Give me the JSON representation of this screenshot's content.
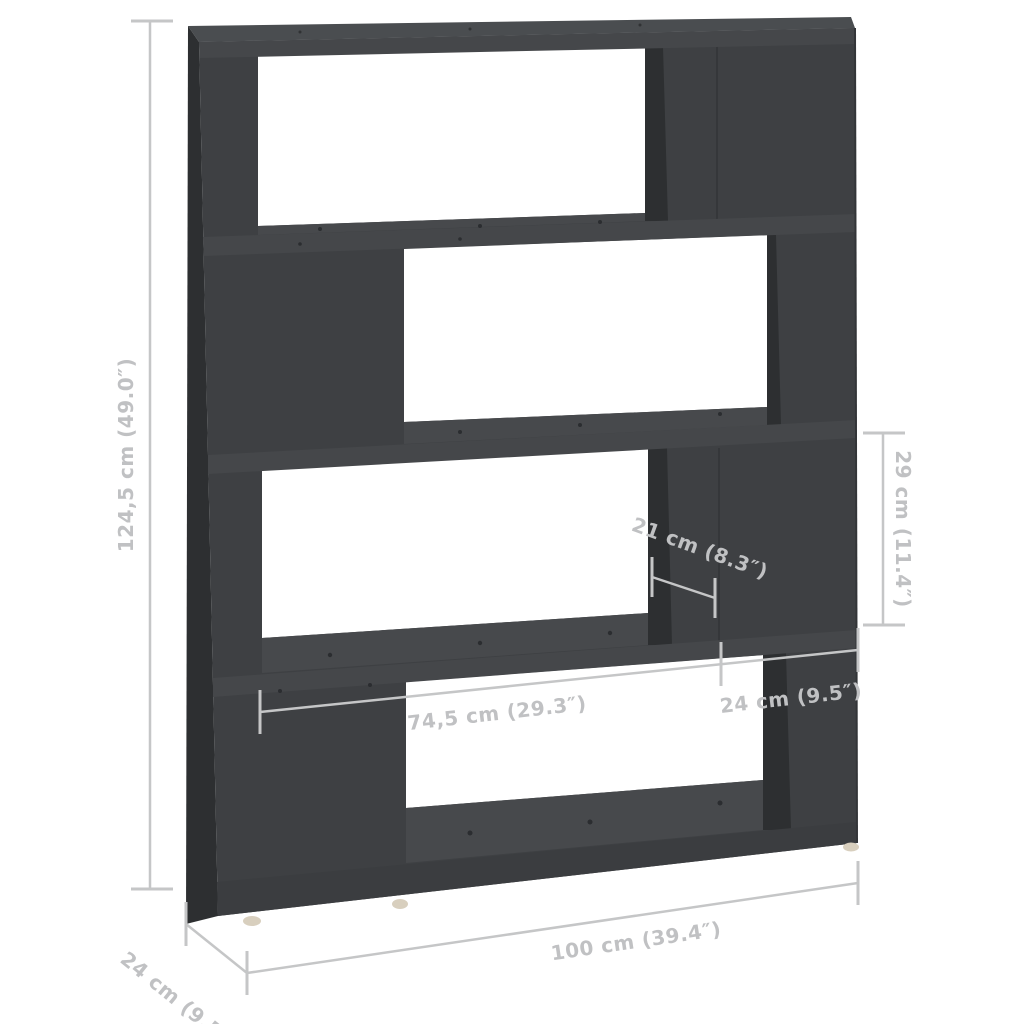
{
  "figure": {
    "kind": "product-dimension-diagram",
    "subject": "4-tier zig-zag book cabinet / room divider, dark gray, on white background",
    "background": "#ffffff"
  },
  "colors": {
    "furniture_front": "#3e4043",
    "furniture_side_shadow": "#2d2f31",
    "furniture_top_surface": "#47494c",
    "top_board_surface": "#4a4d50",
    "shelf_front": "#45474a",
    "bottom_board_front": "#3b3d40",
    "dimension_lines": "#c5c6c7",
    "dimension_text": "#c0c1c3",
    "feet": "#d8cfbe"
  },
  "dimensions": {
    "overall_height": {
      "label": "124,5 cm (49.0″)"
    },
    "overall_width": {
      "label": "100 cm (39.4″)"
    },
    "overall_depth": {
      "label": "24 cm (9.5″)"
    },
    "compartment_width": {
      "label": "74,5 cm (29.3″)"
    },
    "side_section_width": {
      "label": "24 cm (9.5″)"
    },
    "compartment_depth": {
      "label": "21 cm (8.3″)"
    },
    "compartment_height": {
      "label": "29 cm (11.4″)"
    }
  }
}
